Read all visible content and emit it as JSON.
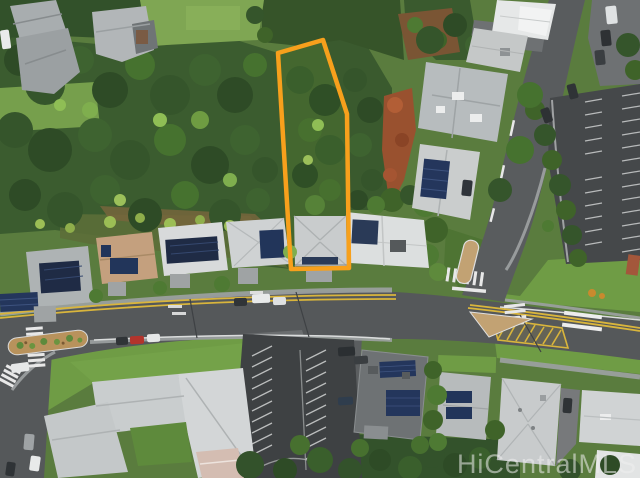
{
  "scene": {
    "type": "aerial-drone-photograph",
    "subject": "Vacant wooded residential parcel outlined in orange beside a suburban road intersection"
  },
  "watermark": {
    "text": "HiCentralMLS",
    "color": "#EFEFEF",
    "opacity": "0.55"
  },
  "property_outline": {
    "points": "278,53 323,40 347,114 349,268 291,269",
    "color": "#F7A01C",
    "stroke_width": "4.5"
  },
  "palette": {
    "road": "#55585A",
    "parking_lot": "#3E4143",
    "forest": "#3B5C2F",
    "lawn": "#6F9C45",
    "roof_gray": "#C9CCCD",
    "solar_panel": "#22355A",
    "red_dirt": "#99512F",
    "median_tan": "#C2A273",
    "lane_yellow": "#D9B53C"
  }
}
